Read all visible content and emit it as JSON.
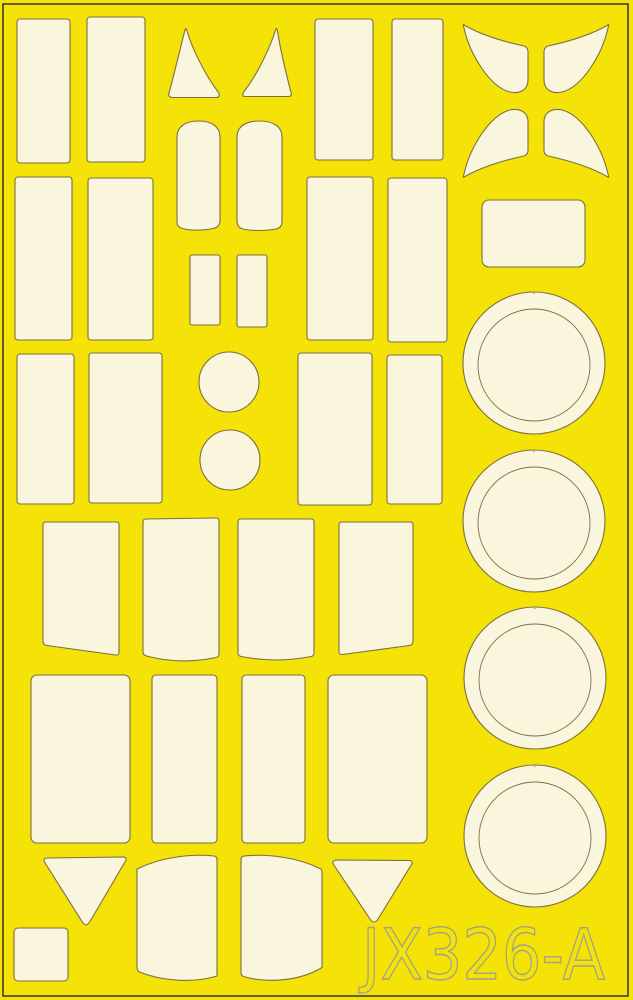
{
  "sheet": {
    "label": "JX326-A",
    "background_color": "#F5E206",
    "piece_fill": "#FAF6DE",
    "piece_outline": "#7A7040",
    "border_color": "#3F3D2B",
    "label_stroke": "#A2A28C",
    "width": 633,
    "height": 1000
  },
  "shapes": [
    {
      "id": "mask-rect-row1-col1",
      "type": "rect",
      "x": 17,
      "y": 19,
      "w": 53,
      "h": 144,
      "rx": 3
    },
    {
      "id": "mask-rect-row1-col2",
      "type": "rect",
      "x": 87,
      "y": 17,
      "w": 58,
      "h": 145,
      "rx": 3
    },
    {
      "id": "mask-triangle-up-1",
      "type": "path",
      "d": "M185,30 C181,45 174,75 169,93 C168,96 170,97.5 172.5,97.5 L216.5,97.5 C219,97.5 220,95.5 218.5,92.5 C205,75 192,48 187,31 C186,28 185.8,28 185,30 Z"
    },
    {
      "id": "mask-triangle-up-2",
      "type": "path",
      "d": "M275.5,30 C271,45 258,74 244,91.5 C241.8,94.5 242.5,96.5 245,96.5 L288.5,96.5 C291,96.5 291.8,95 291,92.5 C286.5,75 280,48 277.5,31 C276.8,27.8 276.2,27.8 275.5,30 Z"
    },
    {
      "id": "mask-rect-row1-col3",
      "type": "rect",
      "x": 315,
      "y": 19,
      "w": 58,
      "h": 141,
      "rx": 3
    },
    {
      "id": "mask-rect-row1-col4",
      "type": "rect",
      "x": 392,
      "y": 19,
      "w": 51,
      "h": 141,
      "rx": 3
    },
    {
      "id": "mask-wing-top-left",
      "type": "path",
      "d": "M464,25 C485,37 510,43 524,46 C527,47 528,49 528,52 L528,80 C528,90 520,94 510,92 C490,87 470,55 464,28 C463,25 463,24 464,25 Z"
    },
    {
      "id": "mask-wing-top-right",
      "type": "path",
      "d": "M608,25 C587,37 562,43 548,46 C545,47 544,49 544,52 L544,80 C544,90 552,94 562,92 C582,87 602,55 608,28 C609,25 609,24 608,25 Z"
    },
    {
      "id": "mask-wing-bottom-left",
      "type": "path",
      "d": "M464,177 C485,165 510,159 524,156 C527,155 528,153 528,150 L528,122 C528,112 520,108 510,110 C490,115 470,147 464,174 C463,177 463,178 464,177 Z"
    },
    {
      "id": "mask-wing-bottom-right",
      "type": "path",
      "d": "M608,177 C587,165 562,159 548,156 C545,155 544,153 544,150 L544,122 C544,112 552,108 562,110 C582,115 602,147 608,174 C609,177 609,178 608,177 Z"
    },
    {
      "id": "mask-arch-1",
      "type": "path",
      "d": "M177,137 C177,127 185,121 198.5,121 C212,121 220,127 220,137 L220,220 C220,225 218,227.5 213,228.5 C200,231 188,230.5 181,228 C178,227 177,225 177,222 Z"
    },
    {
      "id": "mask-arch-2",
      "type": "path",
      "d": "M237,137 C237,127 245,121 259.5,121 C274,121 282,127 282,137 L282,222 C282,226 280,228 276,229 C265,231 251,231 243,229 C239,228 237,225.5 237,220.5 Z"
    },
    {
      "id": "mask-small-rect-1",
      "type": "rect",
      "x": 190,
      "y": 255,
      "w": 30,
      "h": 70,
      "rx": 2
    },
    {
      "id": "mask-small-rect-2",
      "type": "rect",
      "x": 237,
      "y": 255,
      "w": 30,
      "h": 72,
      "rx": 2
    },
    {
      "id": "mask-rect-row2-col1",
      "type": "rect",
      "x": 15,
      "y": 177,
      "w": 57,
      "h": 163,
      "rx": 3
    },
    {
      "id": "mask-rect-row2-col2",
      "type": "rect",
      "x": 88,
      "y": 178,
      "w": 65,
      "h": 162,
      "rx": 3
    },
    {
      "id": "mask-rect-row2-col3",
      "type": "rect",
      "x": 307,
      "y": 177,
      "w": 66,
      "h": 163,
      "rx": 3
    },
    {
      "id": "mask-rect-row2-col4",
      "type": "rect",
      "x": 388,
      "y": 178,
      "w": 59,
      "h": 164,
      "rx": 3
    },
    {
      "id": "mask-wide-rect",
      "type": "rect",
      "x": 482,
      "y": 200,
      "w": 103,
      "h": 67,
      "rx": 7
    },
    {
      "id": "mask-wheel-ring-1",
      "type": "ring",
      "cx": 534,
      "cy": 363,
      "rOuter": 71,
      "rInner": 56
    },
    {
      "id": "mask-wheel-ring-2",
      "type": "ring",
      "cx": 534,
      "cy": 521,
      "rOuter": 71,
      "rInner": 56
    },
    {
      "id": "mask-wheel-ring-3",
      "type": "ring",
      "cx": 535,
      "cy": 678,
      "rOuter": 71,
      "rInner": 56
    },
    {
      "id": "mask-wheel-ring-4",
      "type": "ring",
      "cx": 535,
      "cy": 836,
      "rOuter": 71,
      "rInner": 56
    },
    {
      "id": "mask-rect-row3-col1",
      "type": "rect",
      "x": 17,
      "y": 354,
      "w": 57,
      "h": 150,
      "rx": 3
    },
    {
      "id": "mask-rect-row3-col2",
      "type": "rect",
      "x": 89,
      "y": 353,
      "w": 73,
      "h": 150,
      "rx": 3
    },
    {
      "id": "mask-circle-1",
      "type": "circle",
      "cx": 229,
      "cy": 382,
      "r": 30
    },
    {
      "id": "mask-circle-2",
      "type": "circle",
      "cx": 230,
      "cy": 460,
      "r": 30
    },
    {
      "id": "mask-rect-row3-col3",
      "type": "rect",
      "x": 298,
      "y": 353,
      "w": 74,
      "h": 152,
      "rx": 3
    },
    {
      "id": "mask-rect-row3-col4",
      "type": "rect",
      "x": 387,
      "y": 355,
      "w": 55,
      "h": 149,
      "rx": 3
    },
    {
      "id": "mask-canopy-quad-1",
      "type": "path",
      "d": "M46,522 L117,522 Q119,522 119,525 L119,652 Q119,655.5 115.5,655 L47,645.5 Q43,645 43,641 L43,525 Q43,522 46,522 Z"
    },
    {
      "id": "mask-canopy-quad-2",
      "type": "path",
      "d": "M146,519 L216,518 Q219,518 219,521 L219,654 Q219,657 216,657.5 Q180,665 146.5,656 Q143,655 143,652 L143,522 Q143,519 146,519 Z"
    },
    {
      "id": "mask-canopy-quad-3",
      "type": "path",
      "d": "M241,519 L311,519 Q314,519 314,522 L314,653 Q314,656 311,656.5 Q276,663.5 241.5,656.5 Q238,656 238,653 L238,522 Q238,519 241,519 Z"
    },
    {
      "id": "mask-canopy-quad-4",
      "type": "path",
      "d": "M342,522 L410,522 Q413,522 413,525 L413,641 Q413,645 409.5,645.5 L342.5,654.5 Q339,655 339,651.5 L339,525 Q339,522 342,522 Z"
    },
    {
      "id": "mask-rect-row5-col1",
      "type": "rect",
      "x": 31,
      "y": 675,
      "w": 99,
      "h": 168,
      "rx": 6
    },
    {
      "id": "mask-rect-row5-col2",
      "type": "rect",
      "x": 152,
      "y": 675,
      "w": 65,
      "h": 168,
      "rx": 4
    },
    {
      "id": "mask-rect-row5-col3",
      "type": "rect",
      "x": 242,
      "y": 675,
      "w": 63,
      "h": 168,
      "rx": 4
    },
    {
      "id": "mask-rect-row5-col4",
      "type": "rect",
      "x": 328,
      "y": 675,
      "w": 99,
      "h": 168,
      "rx": 6
    },
    {
      "id": "mask-triangle-down-1",
      "type": "path",
      "d": "M47,858 L123.5,857 Q127.5,857.5 125.5,861 L90,921.5 Q86,928 82,921.5 L44.5,862 Q42.5,858.5 47,858 Z"
    },
    {
      "id": "mask-small-square",
      "type": "rect",
      "x": 14,
      "y": 928,
      "w": 54,
      "h": 53,
      "rx": 4
    },
    {
      "id": "mask-windscreen-side-1",
      "type": "path",
      "d": "M137,869 C160,857.5 190,853.5 214,856 Q217,856.5 217,859.5 L217,976 C192,983.5 162,981 139.5,972 Q137,970.5 137,967.5 Z"
    },
    {
      "id": "mask-windscreen-side-2",
      "type": "path",
      "d": "M244,856 C268,853.5 298,857.5 321,869 Q322,870 322,872 L322,967.5 C300,981 268,983.5 243.5,976.5 Q241,975.5 241,972.5 L241,859.5 Q241,856.5 244,856 Z"
    },
    {
      "id": "mask-triangle-down-2",
      "type": "path",
      "d": "M336,860 L409.5,860.5 Q413.5,861 411.5,864.5 L378,919 Q374,925 370,919 L333.5,864.5 Q331.5,861 336,860 Z"
    }
  ]
}
